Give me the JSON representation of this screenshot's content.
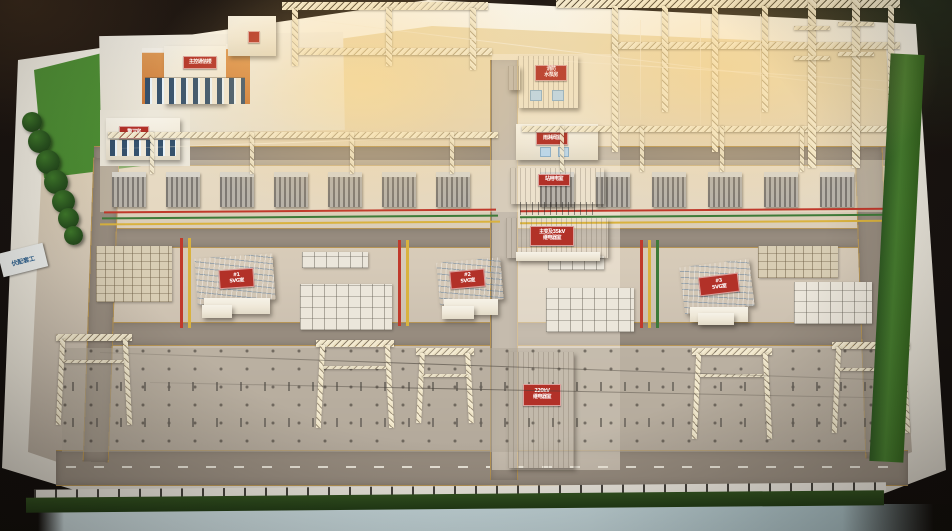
{
  "scene": {
    "description": "Photograph of a physical architectural scale model of a 220kV substation yard for a photovoltaic supporting project"
  },
  "placard": {
    "text": "伏配套工"
  },
  "signs": {
    "main_control": "主控通信楼",
    "guard": "警卫室",
    "pump_house": "消防\n水泵房",
    "valve_room": "雨淋阀室",
    "station_power": "站用电室",
    "mv_relay": "主变及35kV\n继电器室",
    "relay_220kv": "220kV\n继电器室",
    "svg_room_1": "#1\nSVG室",
    "svg_room_2": "#2\nSVG室",
    "svg_room_3": "#3\nSVG室"
  },
  "colors": {
    "sign_red": "#b23128",
    "busbar_red": "#c0392b",
    "busbar_green": "#3e7a38",
    "busbar_yellow": "#d9b23e",
    "svg_roof_blue": "#a9c9e0",
    "lawn_green": "#4a8a2e",
    "table_white": "#f2eee4",
    "base_edge_blue": "#c9dade",
    "ground_warm": "#ead9b2",
    "ground_cool": "#b5aa9c",
    "road_gray": "#978c7f",
    "road_line_yellow": "#cda75e",
    "truss_cream": "#f2e9cf",
    "building_orange": "#d08040"
  }
}
